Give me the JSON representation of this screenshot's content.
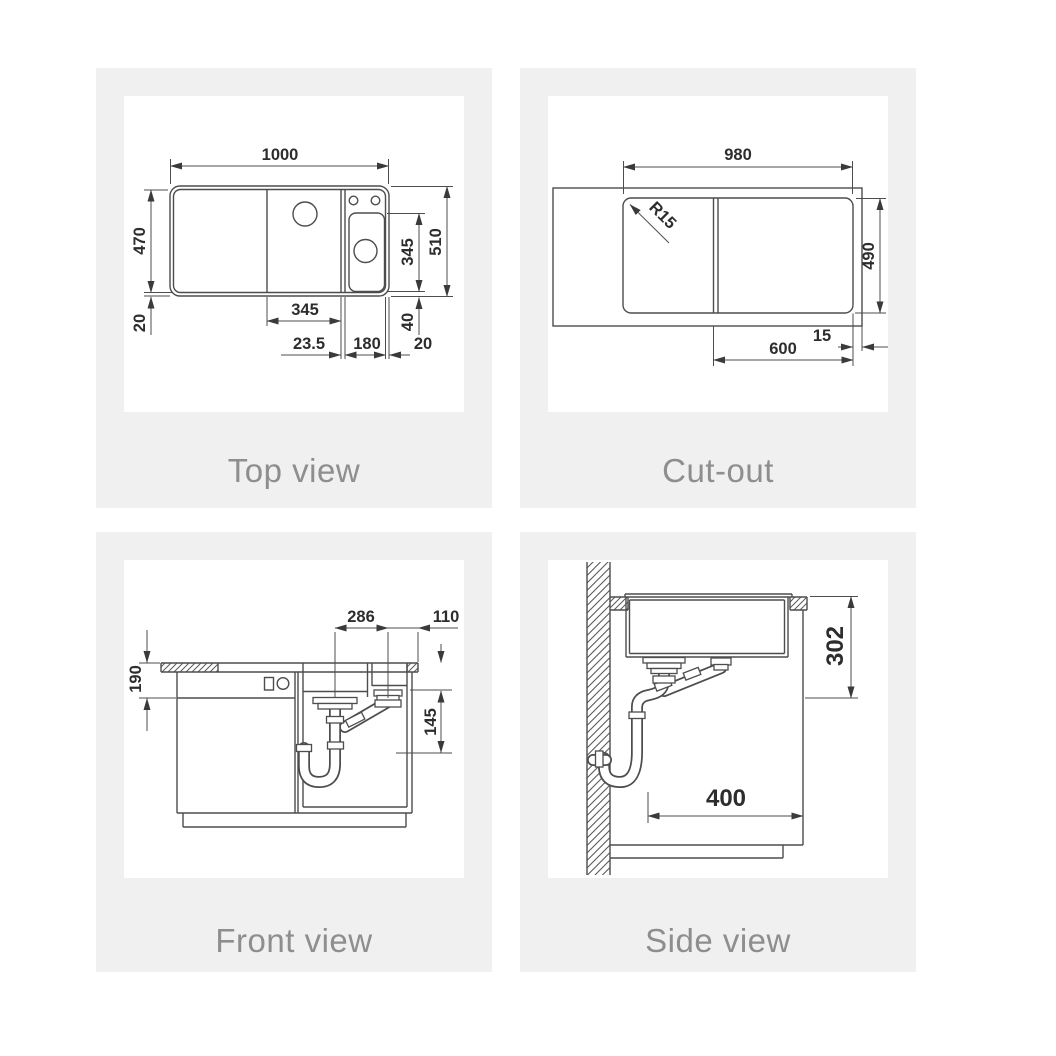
{
  "colors": {
    "page_bg": "#ffffff",
    "panel_bg": "#f0f0f0",
    "line": "#4d4d4d",
    "dim_text": "#2d2d2d",
    "label_text": "#8e8e8e"
  },
  "panels": [
    {
      "id": "top-view",
      "label": "Top view",
      "dims": {
        "overall_width": "1000",
        "bowl_depth": "470",
        "rim_bottom": "20",
        "tray_depth": "345",
        "overall_depth": "510",
        "main_bowl_width": "345",
        "divider_width": "23.5",
        "tray_width": "180",
        "rim_right": "20",
        "tray_bottom_gap": "40"
      }
    },
    {
      "id": "cut-out",
      "label": "Cut-out",
      "dims": {
        "cutout_width": "980",
        "corner_radius": "R15",
        "cutout_depth": "490",
        "bowl_section_width": "600",
        "edge_gap": "15"
      }
    },
    {
      "id": "front-view",
      "label": "Front view",
      "dims": {
        "drain_spacing": "286",
        "drain_edge_offset": "110",
        "apron_height": "190",
        "trap_clearance": "145"
      }
    },
    {
      "id": "side-view",
      "label": "Side view",
      "dims": {
        "install_depth": "302",
        "wall_clearance": "400"
      }
    }
  ]
}
